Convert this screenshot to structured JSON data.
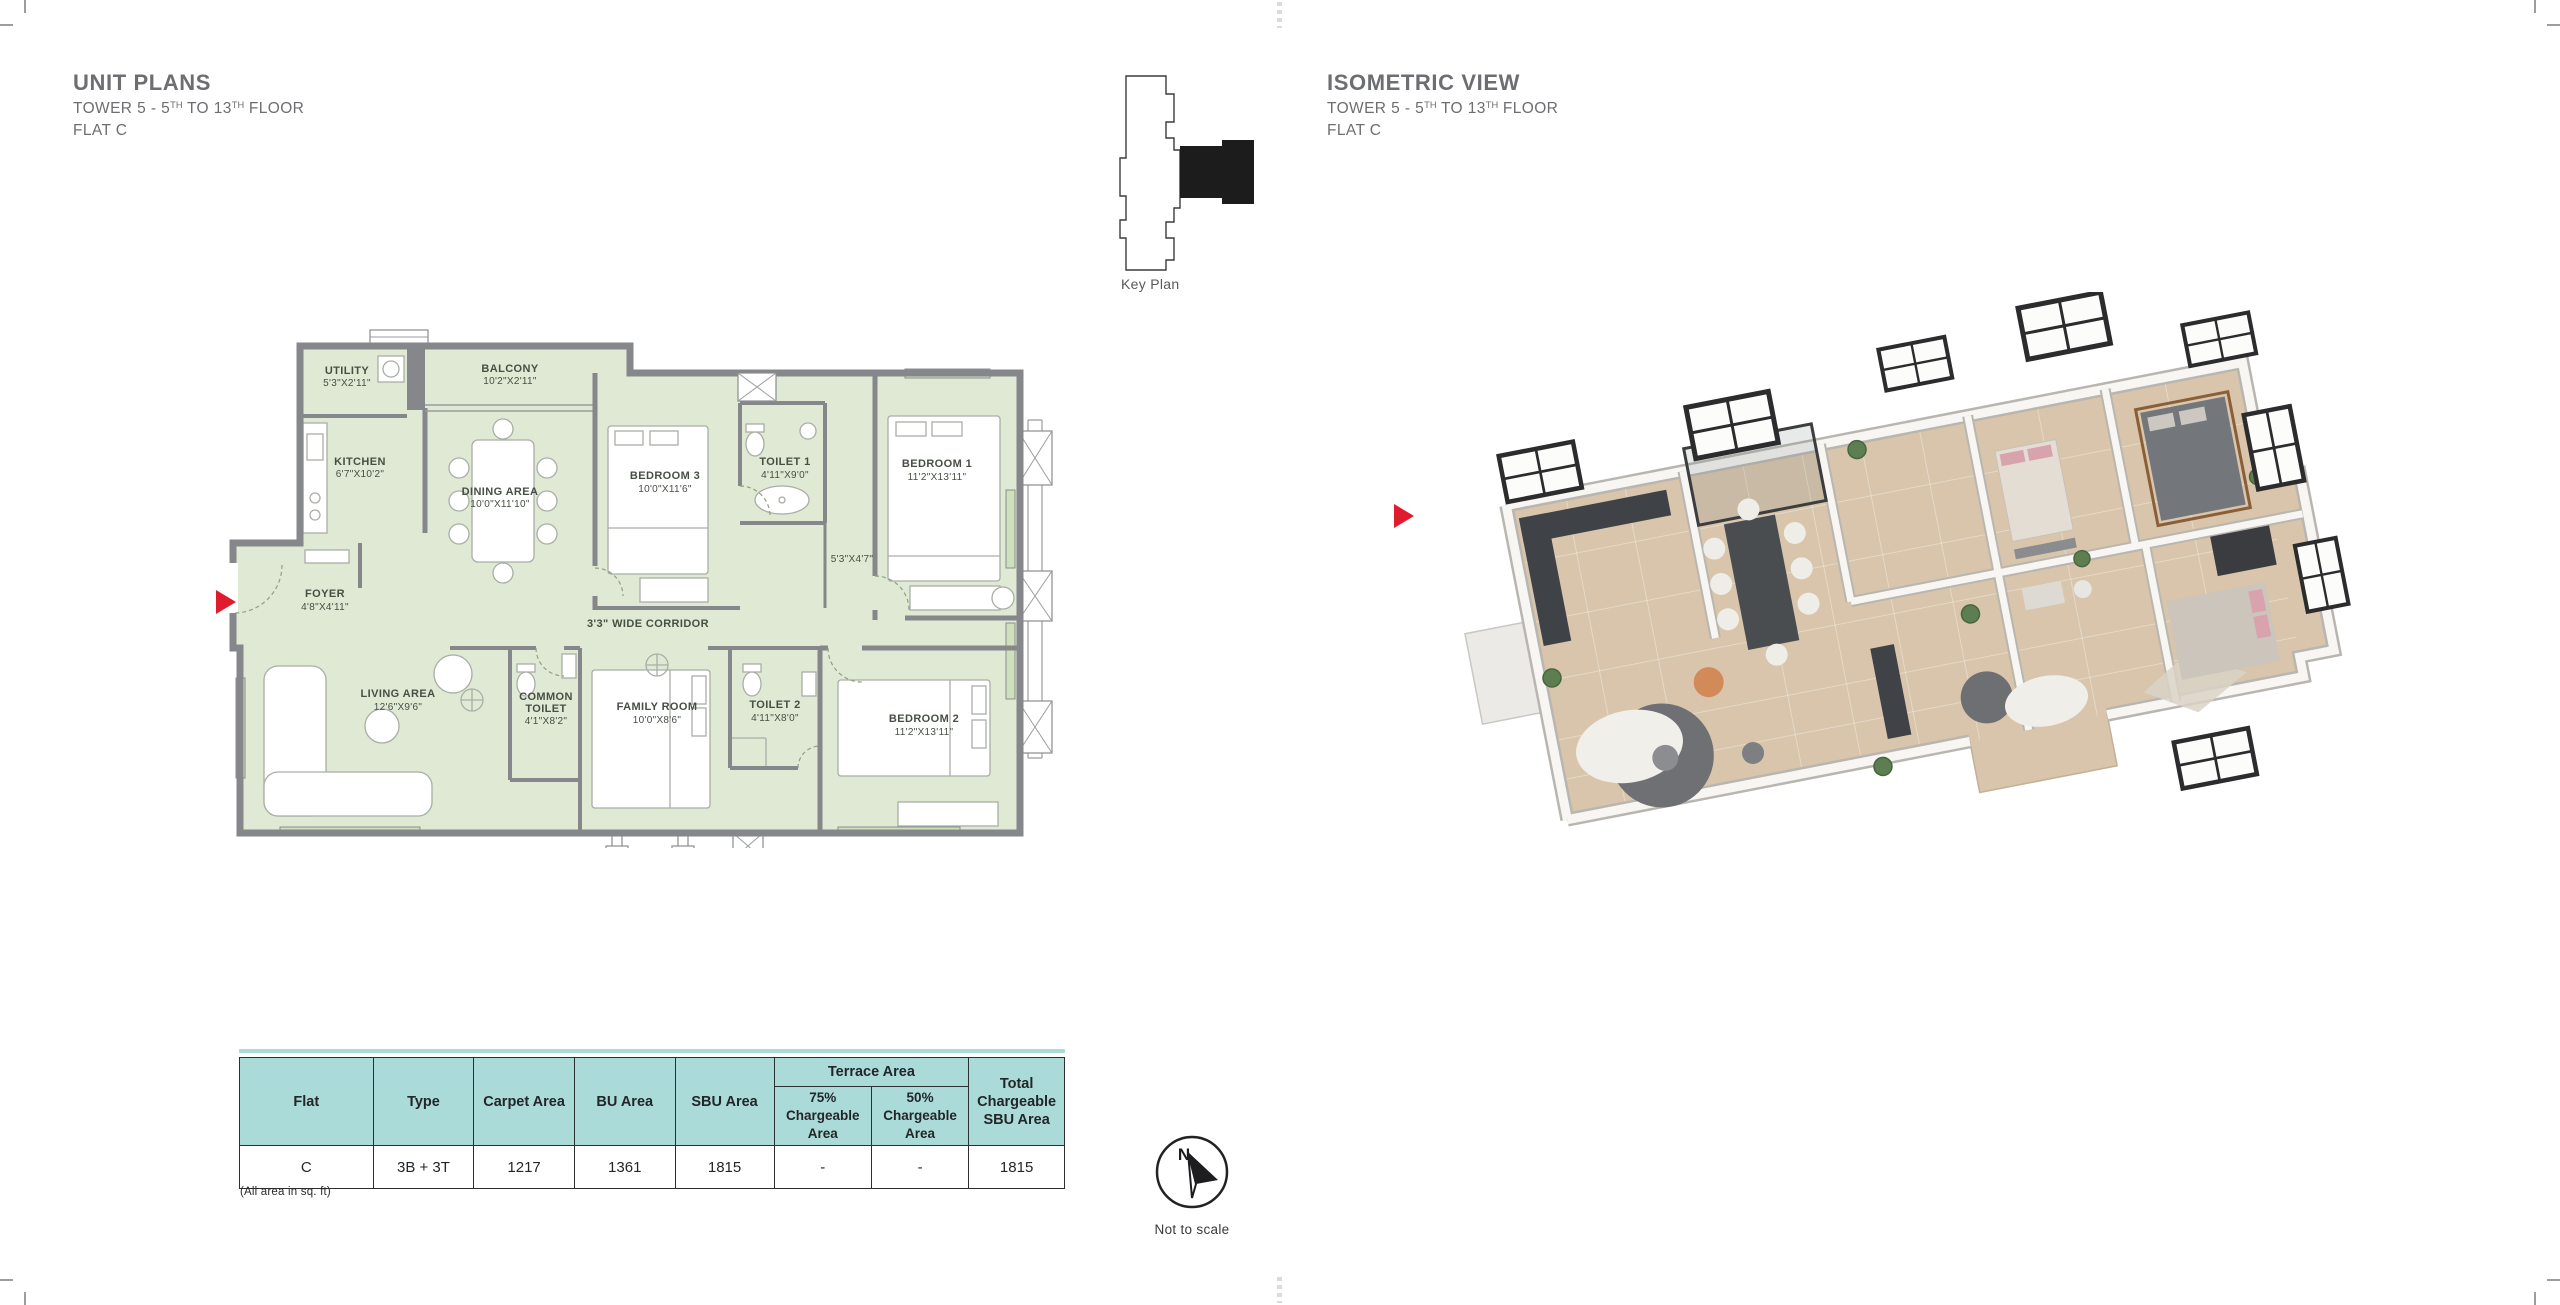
{
  "colors": {
    "title_gray": "#6d6e71",
    "plan_green": "#dfe9d4",
    "wall_gray": "#85878a",
    "label_green": "#474f45",
    "table_header": "#abdbd8",
    "accent_red": "#e01b2d",
    "iso_floor": "#d8c5ab"
  },
  "header_left": {
    "title": "UNIT PLANS",
    "line2": [
      "TOWER 5 - 5",
      "TH",
      " TO 13",
      "TH",
      " FLOOR"
    ],
    "line3": "FLAT C"
  },
  "header_right": {
    "title": "ISOMETRIC VIEW",
    "line2": [
      "TOWER 5 - 5",
      "TH",
      " TO 13",
      "TH",
      " FLOOR"
    ],
    "line3": "FLAT C"
  },
  "key_plan": {
    "label": "Key Plan"
  },
  "plan": {
    "corridor_label": "3'3\" WIDE CORRIDOR",
    "passage_dim": "5'3\"X4'7\"",
    "rooms": {
      "utility": {
        "name": "UTILITY",
        "dim": "5'3\"X2'11\""
      },
      "balcony": {
        "name": "BALCONY",
        "dim": "10'2\"X2'11\""
      },
      "kitchen": {
        "name": "KITCHEN",
        "dim": "6'7\"X10'2\""
      },
      "dining": {
        "name": "DINING AREA",
        "dim": "10'0\"X11'10\""
      },
      "bedroom3": {
        "name": "BEDROOM 3",
        "dim": "10'0\"X11'6\""
      },
      "toilet1": {
        "name": "TOILET 1",
        "dim": "4'11\"X9'0\""
      },
      "bedroom1": {
        "name": "BEDROOM 1",
        "dim": "11'2\"X13'11\""
      },
      "foyer": {
        "name": "FOYER",
        "dim": "4'8\"X4'11\""
      },
      "living": {
        "name": "LIVING AREA",
        "dim": "12'6\"X9'6\""
      },
      "common_toilet": {
        "name1": "COMMON",
        "name2": "TOILET",
        "dim": "4'1\"X8'2\""
      },
      "family": {
        "name": "FAMILY ROOM",
        "dim": "10'0\"X8'6\""
      },
      "toilet2": {
        "name": "TOILET 2",
        "dim": "4'11\"X8'0\""
      },
      "bedroom2": {
        "name": "BEDROOM 2",
        "dim": "11'2\"X13'11\""
      }
    }
  },
  "table": {
    "headers": {
      "flat": "Flat",
      "type": "Type",
      "carpet": "Carpet Area",
      "bu": "BU Area",
      "sbu": "SBU Area",
      "terrace": "Terrace Area",
      "t75": "75% Chargeable Area",
      "t50": "50% Chargeable Area",
      "total": "Total Chargeable SBU Area"
    },
    "row": {
      "flat": "C",
      "type": "3B + 3T",
      "carpet": "1217",
      "bu": "1361",
      "sbu": "1815",
      "t75": "-",
      "t50": "-",
      "total": "1815"
    },
    "footnote": "(All area in sq. ft)"
  },
  "compass": {
    "north": "N",
    "note": "Not to scale"
  }
}
